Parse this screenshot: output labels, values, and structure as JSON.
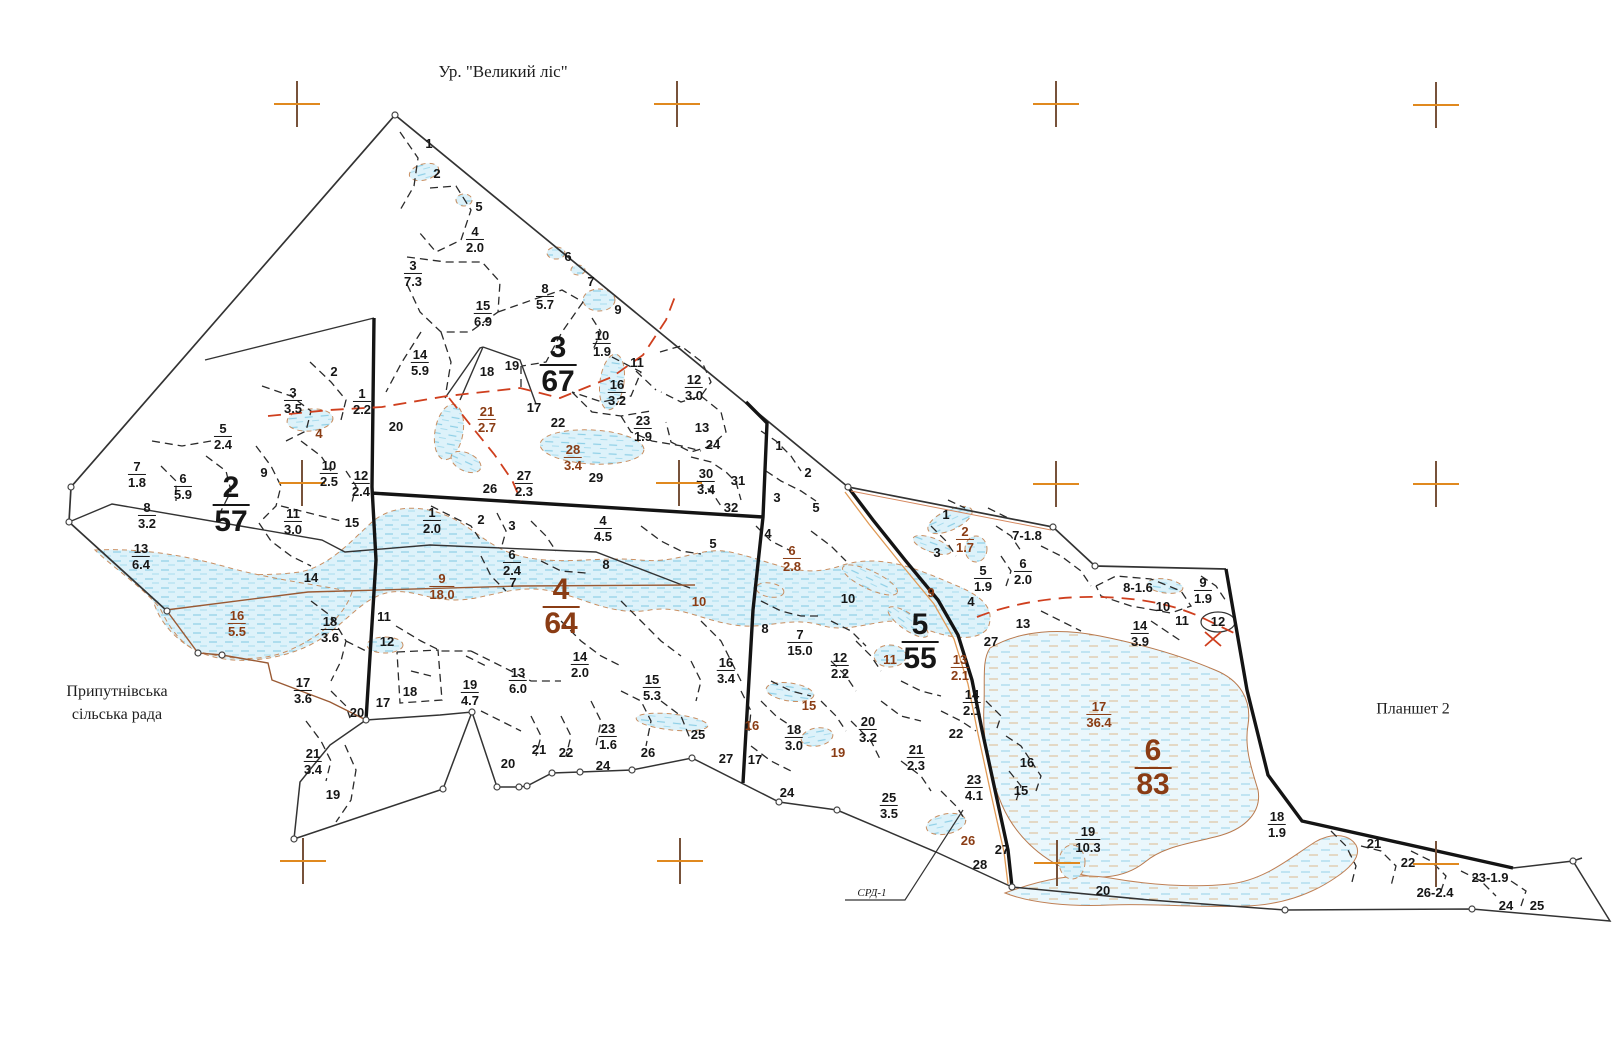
{
  "title": "Ур. \"Великий ліс\"",
  "annotations": {
    "village_line1": "Припутнівська",
    "village_line2": "сільська рада",
    "plansheet": "Планшет 2",
    "srd": "СРД-1"
  },
  "colors": {
    "cross_orange": "#e0891f",
    "cross_brown": "#77523a",
    "label_black": "#161616",
    "label_brown": "#8a3c14",
    "road_red": "#cf3f1e",
    "road_orange": "#e09a55",
    "water_fill": "#ddf2fa",
    "water_hatch": "#8ecfe6",
    "wetland_outline": "#c98f62",
    "boundary_black": "#222222"
  },
  "map": {
    "quarter_labels": [
      {
        "x": 231,
        "y": 505,
        "t": "2",
        "b": "57",
        "s": "lg"
      },
      {
        "x": 558,
        "y": 365,
        "t": "3",
        "b": "67",
        "s": "lg"
      },
      {
        "x": 561,
        "y": 607,
        "t": "4",
        "b": "64",
        "s": "lg",
        "c": "bn"
      },
      {
        "x": 920,
        "y": 642,
        "t": "5",
        "b": "55",
        "s": "lg"
      },
      {
        "x": 1153,
        "y": 768,
        "t": "6",
        "b": "83",
        "s": "lg",
        "c": "bn"
      }
    ],
    "labels": [
      {
        "x": 429,
        "y": 144,
        "t": "1"
      },
      {
        "x": 437,
        "y": 174,
        "t": "2"
      },
      {
        "x": 479,
        "y": 207,
        "t": "5"
      },
      {
        "x": 475,
        "y": 240,
        "t": "4",
        "b": "2.0"
      },
      {
        "x": 413,
        "y": 274,
        "t": "3",
        "b": "7.3"
      },
      {
        "x": 568,
        "y": 257,
        "t": "6"
      },
      {
        "x": 591,
        "y": 282,
        "t": "7"
      },
      {
        "x": 545,
        "y": 297,
        "t": "8",
        "b": "5.7"
      },
      {
        "x": 483,
        "y": 314,
        "t": "15",
        "b": "6.9"
      },
      {
        "x": 618,
        "y": 310,
        "t": "9"
      },
      {
        "x": 602,
        "y": 344,
        "t": "10",
        "b": "1.9"
      },
      {
        "x": 637,
        "y": 363,
        "t": "11"
      },
      {
        "x": 420,
        "y": 363,
        "t": "14",
        "b": "5.9"
      },
      {
        "x": 487,
        "y": 372,
        "t": "18"
      },
      {
        "x": 512,
        "y": 366,
        "t": "19"
      },
      {
        "x": 617,
        "y": 393,
        "t": "16",
        "b": "3.2"
      },
      {
        "x": 694,
        "y": 388,
        "t": "12",
        "b": "3.0"
      },
      {
        "x": 396,
        "y": 427,
        "t": "20"
      },
      {
        "x": 534,
        "y": 408,
        "t": "17"
      },
      {
        "x": 558,
        "y": 423,
        "t": "22"
      },
      {
        "x": 487,
        "y": 420,
        "t": "21",
        "b": "2.7",
        "c": "bn"
      },
      {
        "x": 643,
        "y": 429,
        "t": "23",
        "b": "1.9"
      },
      {
        "x": 702,
        "y": 428,
        "t": "13"
      },
      {
        "x": 713,
        "y": 445,
        "t": "24"
      },
      {
        "x": 573,
        "y": 458,
        "t": "28",
        "b": "3.4",
        "c": "bn"
      },
      {
        "x": 596,
        "y": 478,
        "t": "29"
      },
      {
        "x": 490,
        "y": 489,
        "t": "26"
      },
      {
        "x": 524,
        "y": 484,
        "t": "27",
        "b": "2.3"
      },
      {
        "x": 706,
        "y": 482,
        "t": "30",
        "b": "3.4"
      },
      {
        "x": 738,
        "y": 481,
        "t": "31"
      },
      {
        "x": 731,
        "y": 508,
        "t": "32"
      },
      {
        "x": 334,
        "y": 372,
        "t": "2"
      },
      {
        "x": 293,
        "y": 401,
        "t": "3",
        "b": "3.5"
      },
      {
        "x": 362,
        "y": 402,
        "t": "1",
        "b": "2.2"
      },
      {
        "x": 223,
        "y": 437,
        "t": "5",
        "b": "2.4"
      },
      {
        "x": 319,
        "y": 434,
        "t": "4",
        "c": "bn"
      },
      {
        "x": 264,
        "y": 473,
        "t": "9"
      },
      {
        "x": 329,
        "y": 474,
        "t": "10",
        "b": "2.5"
      },
      {
        "x": 361,
        "y": 484,
        "t": "12",
        "b": "2.4"
      },
      {
        "x": 137,
        "y": 475,
        "t": "7",
        "b": "1.8"
      },
      {
        "x": 183,
        "y": 487,
        "t": "6",
        "b": "5.9"
      },
      {
        "x": 147,
        "y": 516,
        "t": "8",
        "b": "3.2"
      },
      {
        "x": 293,
        "y": 522,
        "t": "11",
        "b": "3.0"
      },
      {
        "x": 352,
        "y": 523,
        "t": "15"
      },
      {
        "x": 141,
        "y": 557,
        "t": "13",
        "b": "6.4"
      },
      {
        "x": 311,
        "y": 578,
        "t": "14"
      },
      {
        "x": 237,
        "y": 624,
        "t": "16",
        "b": "5.5",
        "c": "bn"
      },
      {
        "x": 330,
        "y": 630,
        "t": "18",
        "b": "3.6"
      },
      {
        "x": 303,
        "y": 691,
        "t": "17",
        "b": "3.6"
      },
      {
        "x": 357,
        "y": 713,
        "t": "20"
      },
      {
        "x": 313,
        "y": 762,
        "t": "21",
        "b": "3.4"
      },
      {
        "x": 333,
        "y": 795,
        "t": "19"
      },
      {
        "x": 432,
        "y": 521,
        "t": "1",
        "b": "2.0"
      },
      {
        "x": 481,
        "y": 520,
        "t": "2"
      },
      {
        "x": 512,
        "y": 526,
        "t": "3"
      },
      {
        "x": 603,
        "y": 529,
        "t": "4",
        "b": "4.5"
      },
      {
        "x": 512,
        "y": 563,
        "t": "6",
        "b": "2.4"
      },
      {
        "x": 513,
        "y": 583,
        "t": "7"
      },
      {
        "x": 606,
        "y": 565,
        "t": "8"
      },
      {
        "x": 713,
        "y": 544,
        "t": "5"
      },
      {
        "x": 442,
        "y": 587,
        "t": "9",
        "b": "18.0",
        "c": "bn"
      },
      {
        "x": 699,
        "y": 602,
        "t": "10",
        "c": "bn"
      },
      {
        "x": 384,
        "y": 617,
        "t": "11"
      },
      {
        "x": 387,
        "y": 642,
        "t": "12"
      },
      {
        "x": 580,
        "y": 665,
        "t": "14",
        "b": "2.0"
      },
      {
        "x": 518,
        "y": 681,
        "t": "13",
        "b": "6.0"
      },
      {
        "x": 652,
        "y": 688,
        "t": "15",
        "b": "5.3"
      },
      {
        "x": 470,
        "y": 693,
        "t": "19",
        "b": "4.7"
      },
      {
        "x": 410,
        "y": 692,
        "t": "18"
      },
      {
        "x": 383,
        "y": 703,
        "t": "17"
      },
      {
        "x": 726,
        "y": 671,
        "t": "16",
        "b": "3.4"
      },
      {
        "x": 698,
        "y": 735,
        "t": "25"
      },
      {
        "x": 508,
        "y": 764,
        "t": "20"
      },
      {
        "x": 539,
        "y": 750,
        "t": "21"
      },
      {
        "x": 566,
        "y": 753,
        "t": "22"
      },
      {
        "x": 608,
        "y": 737,
        "t": "23",
        "b": "1.6"
      },
      {
        "x": 603,
        "y": 766,
        "t": "24"
      },
      {
        "x": 648,
        "y": 753,
        "t": "26"
      },
      {
        "x": 726,
        "y": 759,
        "t": "27"
      },
      {
        "x": 752,
        "y": 726,
        "t": "16",
        "c": "bn"
      },
      {
        "x": 755,
        "y": 760,
        "t": "17"
      },
      {
        "x": 779,
        "y": 446,
        "t": "1"
      },
      {
        "x": 808,
        "y": 473,
        "t": "2"
      },
      {
        "x": 777,
        "y": 498,
        "t": "3"
      },
      {
        "x": 816,
        "y": 508,
        "t": "5"
      },
      {
        "x": 768,
        "y": 534,
        "t": "4"
      },
      {
        "x": 792,
        "y": 559,
        "t": "6",
        "b": "2.8",
        "c": "bn"
      },
      {
        "x": 848,
        "y": 599,
        "t": "10"
      },
      {
        "x": 765,
        "y": 629,
        "t": "8"
      },
      {
        "x": 800,
        "y": 643,
        "t": "7",
        "b": "15.0"
      },
      {
        "x": 840,
        "y": 666,
        "t": "12",
        "b": "2.2"
      },
      {
        "x": 890,
        "y": 660,
        "t": "11",
        "c": "bn"
      },
      {
        "x": 931,
        "y": 593,
        "t": "9",
        "c": "bn"
      },
      {
        "x": 960,
        "y": 668,
        "t": "13",
        "b": "2.1",
        "c": "bn"
      },
      {
        "x": 972,
        "y": 703,
        "t": "14",
        "b": "2.1"
      },
      {
        "x": 991,
        "y": 642,
        "t": "27"
      },
      {
        "x": 956,
        "y": 734,
        "t": "22"
      },
      {
        "x": 868,
        "y": 730,
        "t": "20",
        "b": "3.2"
      },
      {
        "x": 809,
        "y": 706,
        "t": "15",
        "c": "bn"
      },
      {
        "x": 794,
        "y": 738,
        "t": "18",
        "b": "3.0"
      },
      {
        "x": 838,
        "y": 753,
        "t": "19",
        "c": "bn"
      },
      {
        "x": 916,
        "y": 758,
        "t": "21",
        "b": "2.3"
      },
      {
        "x": 787,
        "y": 793,
        "t": "24"
      },
      {
        "x": 889,
        "y": 806,
        "t": "25",
        "b": "3.5"
      },
      {
        "x": 974,
        "y": 788,
        "t": "23",
        "b": "4.1"
      },
      {
        "x": 1027,
        "y": 763,
        "t": "16"
      },
      {
        "x": 1021,
        "y": 791,
        "t": "15"
      },
      {
        "x": 968,
        "y": 841,
        "t": "26",
        "c": "bn"
      },
      {
        "x": 1002,
        "y": 850,
        "t": "27"
      },
      {
        "x": 980,
        "y": 865,
        "t": "28"
      },
      {
        "x": 946,
        "y": 515,
        "t": "1"
      },
      {
        "x": 965,
        "y": 540,
        "t": "2",
        "b": "1.7",
        "c": "bn"
      },
      {
        "x": 937,
        "y": 553,
        "t": "3"
      },
      {
        "x": 1027,
        "y": 536,
        "t": "7-1.8"
      },
      {
        "x": 983,
        "y": 579,
        "t": "5",
        "b": "1.9"
      },
      {
        "x": 1023,
        "y": 572,
        "t": "6",
        "b": "2.0"
      },
      {
        "x": 971,
        "y": 602,
        "t": "4"
      },
      {
        "x": 1023,
        "y": 624,
        "t": "13"
      },
      {
        "x": 1138,
        "y": 588,
        "t": "8-1.6"
      },
      {
        "x": 1163,
        "y": 607,
        "t": "10"
      },
      {
        "x": 1203,
        "y": 591,
        "t": "9",
        "b": "1.9"
      },
      {
        "x": 1182,
        "y": 621,
        "t": "11"
      },
      {
        "x": 1218,
        "y": 622,
        "t": "12"
      },
      {
        "x": 1140,
        "y": 634,
        "t": "14",
        "b": "3.9"
      },
      {
        "x": 1099,
        "y": 715,
        "t": "17",
        "b": "36.4",
        "c": "bn"
      },
      {
        "x": 1088,
        "y": 840,
        "t": "19",
        "b": "10.3"
      },
      {
        "x": 1103,
        "y": 891,
        "t": "20"
      },
      {
        "x": 1277,
        "y": 825,
        "t": "18",
        "b": "1.9"
      },
      {
        "x": 1374,
        "y": 844,
        "t": "21"
      },
      {
        "x": 1408,
        "y": 863,
        "t": "22"
      },
      {
        "x": 1490,
        "y": 878,
        "t": "23-1.9"
      },
      {
        "x": 1435,
        "y": 893,
        "t": "26-2.4"
      },
      {
        "x": 1506,
        "y": 906,
        "t": "24"
      },
      {
        "x": 1537,
        "y": 906,
        "t": "25"
      }
    ],
    "crosses": [
      [
        297,
        104
      ],
      [
        677,
        104
      ],
      [
        1056,
        104
      ],
      [
        1436,
        105
      ],
      [
        302,
        483
      ],
      [
        679,
        483
      ],
      [
        1056,
        484
      ],
      [
        1436,
        484
      ],
      [
        303,
        861
      ],
      [
        680,
        861
      ],
      [
        1057,
        863
      ],
      [
        1436,
        864
      ]
    ]
  }
}
